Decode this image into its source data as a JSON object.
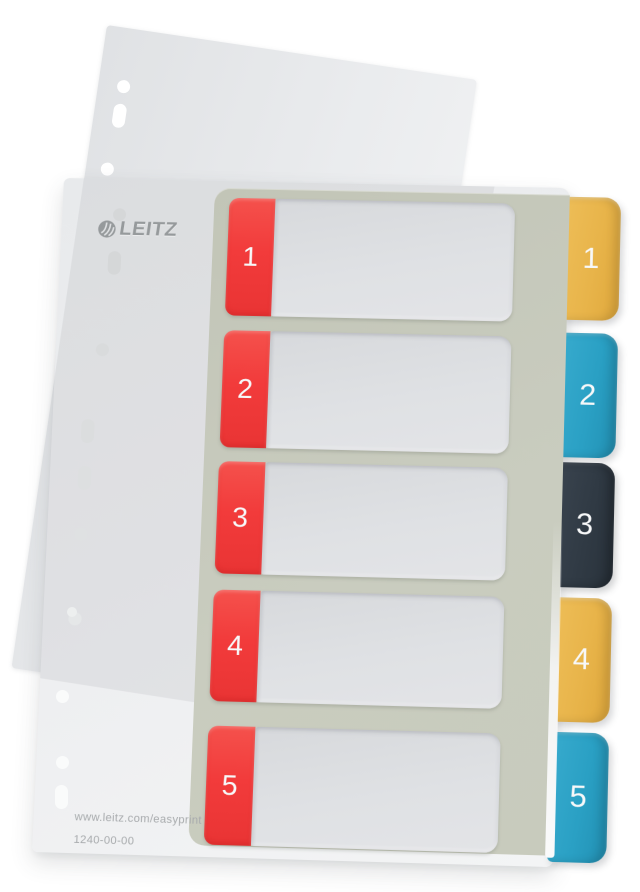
{
  "product": {
    "brand_logo": "LEITZ",
    "website_url": "www.leitz.com/easyprint",
    "article_number": "1240-00-00"
  },
  "colors": {
    "page_bg": "#FFFFFF",
    "red_label": "#F23B3B",
    "sage_panel": "#C8CBBE",
    "white_field": "#DFE1E4",
    "tab_yellow": "#E9B64C",
    "tab_blue": "#2BA2C6",
    "tab_dark": "#303A44",
    "divider_face": "#EFF0F2",
    "pocket_film": "#E6E8EA",
    "number_text": "#F7F8F9",
    "logo_gray": "#969A9C",
    "footer_text": "#A8ABAD"
  },
  "index_rows": [
    {
      "number": "1",
      "top": 17,
      "height": 120
    },
    {
      "number": "2",
      "top": 152,
      "height": 118
    },
    {
      "number": "3",
      "top": 284,
      "height": 112
    },
    {
      "number": "4",
      "top": 412,
      "height": 110
    },
    {
      "number": "5",
      "top": 546,
      "height": 116
    }
  ],
  "index_tabs": [
    {
      "number": "1",
      "color": "yellow",
      "top": 9,
      "height": 125
    },
    {
      "number": "2",
      "color": "blue",
      "top": 147,
      "height": 125
    },
    {
      "number": "3",
      "color": "dark",
      "top": 277,
      "height": 124
    },
    {
      "number": "4",
      "color": "yellow",
      "top": 411,
      "height": 122
    },
    {
      "number": "5",
      "color": "blue",
      "top": 543,
      "height": 126
    }
  ],
  "pocket_holes": [
    {
      "left": 19,
      "top": 52,
      "shape": "round"
    },
    {
      "left": 19,
      "top": 76,
      "shape": "oblong"
    },
    {
      "left": 15,
      "top": 136,
      "shape": "round"
    },
    {
      "left": 3,
      "top": 304,
      "shape": "round"
    },
    {
      "left": 8,
      "top": 346,
      "shape": "oblong"
    },
    {
      "left": 14,
      "top": 392,
      "shape": "oblong"
    },
    {
      "left": 36,
      "top": 561,
      "shape": "round"
    }
  ],
  "divider_holes": [
    {
      "left": 51,
      "top": 30,
      "shape": "round",
      "fill": "#D5D7D8"
    },
    {
      "left": 48,
      "top": 74,
      "shape": "oblong",
      "fill": "#D5D7D8"
    },
    {
      "left": 40,
      "top": 168,
      "shape": "round",
      "fill": "#D9DBDC"
    },
    {
      "left": 29,
      "top": 245,
      "shape": "oblong",
      "fill": "#DBDDDE"
    },
    {
      "left": 28,
      "top": 292,
      "shape": "oblong",
      "fill": "#DDDFE0"
    },
    {
      "left": 27,
      "top": 354,
      "shape": "round",
      "fill": "#DFE1E2"
    },
    {
      "left": 25,
      "top": 438,
      "shape": "round",
      "fill": "#E5E7E8"
    }
  ],
  "background_holes": [
    {
      "left": 67,
      "top": 607,
      "shape": "round",
      "fill": "#EDEFEF",
      "size": "small"
    },
    {
      "left": 56,
      "top": 690,
      "shape": "round",
      "fill": "#FAFBFB"
    },
    {
      "left": 56,
      "top": 756,
      "shape": "round",
      "fill": "#FAFBFB"
    },
    {
      "left": 55,
      "top": 785,
      "shape": "oblong",
      "fill": "#FAFBFB"
    }
  ]
}
